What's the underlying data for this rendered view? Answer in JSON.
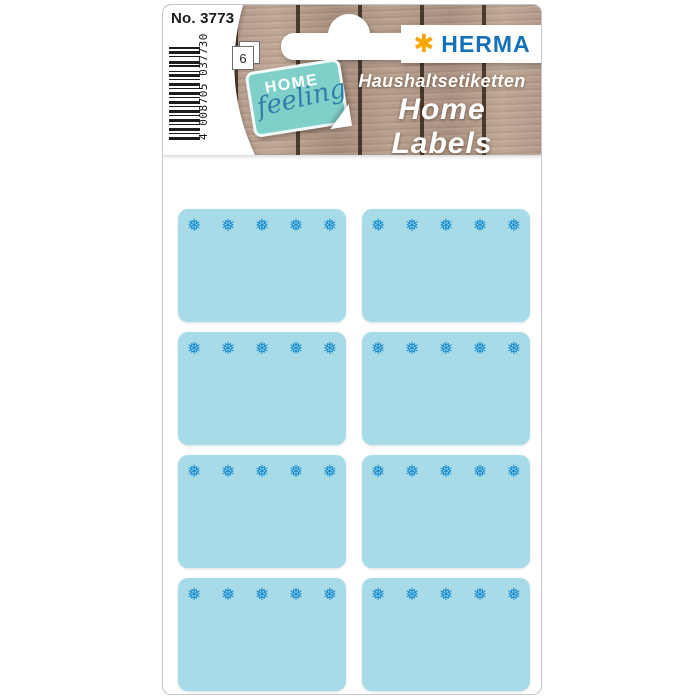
{
  "card": {
    "product_no": "No. 3773",
    "barcode_digits": "4 008705 037730",
    "sheet_count": "6"
  },
  "brand": {
    "logo_text": "HERMA",
    "logo_star": "✱",
    "tag_line1": "HOME",
    "tag_line2": "feeling"
  },
  "titles": {
    "german": "Haushaltsetiketten",
    "english": "Home Labels",
    "french": "Étiquettes ménagères"
  },
  "stickers": {
    "count": 8,
    "rows": 4,
    "columns": 2,
    "snowflakes_per_sticker": 5,
    "snowflake_icon": "❅",
    "fill_color": "#a7dbe8",
    "icon_color": "#1a8ccd"
  },
  "colors": {
    "herma_blue": "#1470b7",
    "herma_star": "#f8a700",
    "tag_teal": "#7ed0c8",
    "tag_script_blue": "#2f7fa9"
  }
}
